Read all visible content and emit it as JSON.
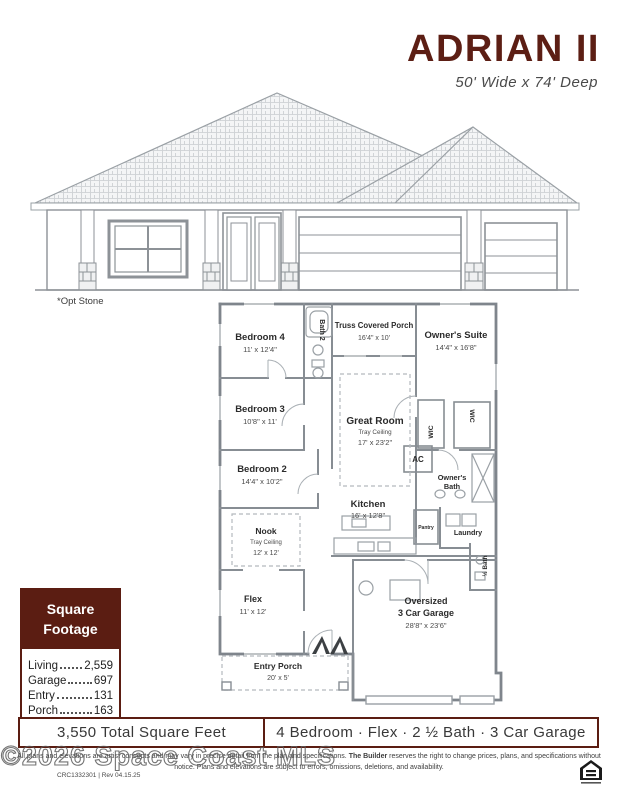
{
  "colors": {
    "accent": "#5B1D12",
    "plan_line_gray": "#878D93",
    "title_maroon": "#5C1E14"
  },
  "header": {
    "title": "ADRIAN II",
    "subtitle": "50' Wide x 74' Deep"
  },
  "elevation": {
    "caption": "*Opt Stone"
  },
  "plan": {
    "rooms": {
      "bedroom4": {
        "name": "Bedroom 4",
        "dims": "11' x 12'4\""
      },
      "bath2": {
        "name": "Bath 2"
      },
      "truss_porch": {
        "name": "Truss Covered Porch",
        "dims": "16'4\" x 10'"
      },
      "owners_suite": {
        "name": "Owner's Suite",
        "dims": "14'4\" x 16'8\""
      },
      "bedroom3": {
        "name": "Bedroom 3",
        "dims": "10'8\" x 11'"
      },
      "great_room": {
        "name": "Great Room",
        "note": "Tray Ceiling",
        "dims": "17' x 23'2\""
      },
      "wic_left": {
        "name": "WIC"
      },
      "wic_right": {
        "name": "WIC"
      },
      "ac": {
        "name": "AC"
      },
      "owners_bath": {
        "name_line1": "Owner's",
        "name_line2": "Bath"
      },
      "bedroom2": {
        "name": "Bedroom 2",
        "dims": "14'4\" x 10'2\""
      },
      "kitchen": {
        "name": "Kitchen",
        "dims": "16' x 12'8\""
      },
      "pantry": {
        "name": "Pantry"
      },
      "laundry": {
        "name": "Laundry"
      },
      "half_bath": {
        "name": "½ Bath"
      },
      "nook": {
        "name": "Nook",
        "note": "Tray Ceiling",
        "dims": "12' x 12'"
      },
      "flex": {
        "name": "Flex",
        "dims": "11' x 12'"
      },
      "entry_porch": {
        "name": "Entry Porch",
        "dims": "20' x 5'"
      },
      "garage": {
        "name_line1": "Oversized",
        "name_line2": "3 Car Garage",
        "dims": "28'8\" x 23'6\""
      }
    }
  },
  "square_footage": {
    "title_line1": "Square",
    "title_line2": "Footage",
    "rows": [
      {
        "label": "Living",
        "value": "2,559"
      },
      {
        "label": "Garage",
        "value": "697"
      },
      {
        "label": "Entry",
        "value": "131"
      },
      {
        "label": "Porch",
        "value": "163"
      }
    ]
  },
  "summary": {
    "total": "3,550 Total Square Feet",
    "features": "4 Bedroom · Flex · 2 ½ Bath · 3 Car Garage"
  },
  "footer": {
    "disclaimer_before_bold": "All plans and elevations are artist concepts and may vary in precise detail from the plan and specifications. ",
    "disclaimer_bold": "The Builder",
    "disclaimer_after_bold": " reserves the right to change prices, plans, and specifications without notice. Plans and elevations are subject to errors, omissions, deletions, and availability.",
    "license": "CRC1332301 | Rev 04.15.25",
    "watermark": "©2026 Space Coast MLS"
  }
}
